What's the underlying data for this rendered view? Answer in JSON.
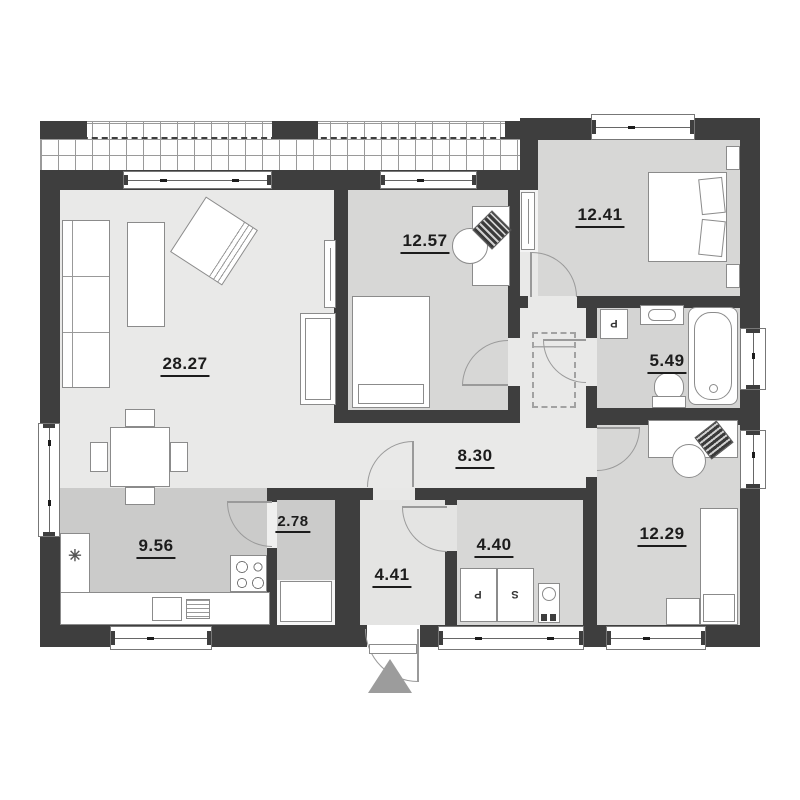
{
  "plan": {
    "title": "single-storey house floor plan",
    "rooms": [
      {
        "name": "living-dining-room",
        "area": "28.27"
      },
      {
        "name": "kitchen",
        "area": "9.56"
      },
      {
        "name": "bedroom-1",
        "area": "12.57"
      },
      {
        "name": "bedroom-2",
        "area": "12.41"
      },
      {
        "name": "bathroom",
        "area": "5.49"
      },
      {
        "name": "hallway",
        "area": "8.30"
      },
      {
        "name": "pantry",
        "area": "2.78"
      },
      {
        "name": "vestibule",
        "area": "4.41"
      },
      {
        "name": "utility-room",
        "area": "4.40"
      },
      {
        "name": "bedroom-3",
        "area": "12.29"
      }
    ],
    "appliance_labels": {
      "washer": "P",
      "dryer": "S",
      "bath_washer": "P"
    },
    "icons": {
      "sink_symbol": "✳"
    },
    "palette": {
      "wall": "#3e3e3e",
      "floor_light": "#e9e9e8",
      "floor_room": "#d7d7d6",
      "floor_kitchen": "#cbcbca",
      "furniture_line": "#8b8b8b",
      "entrance_marker": "#9c9c9c"
    }
  }
}
